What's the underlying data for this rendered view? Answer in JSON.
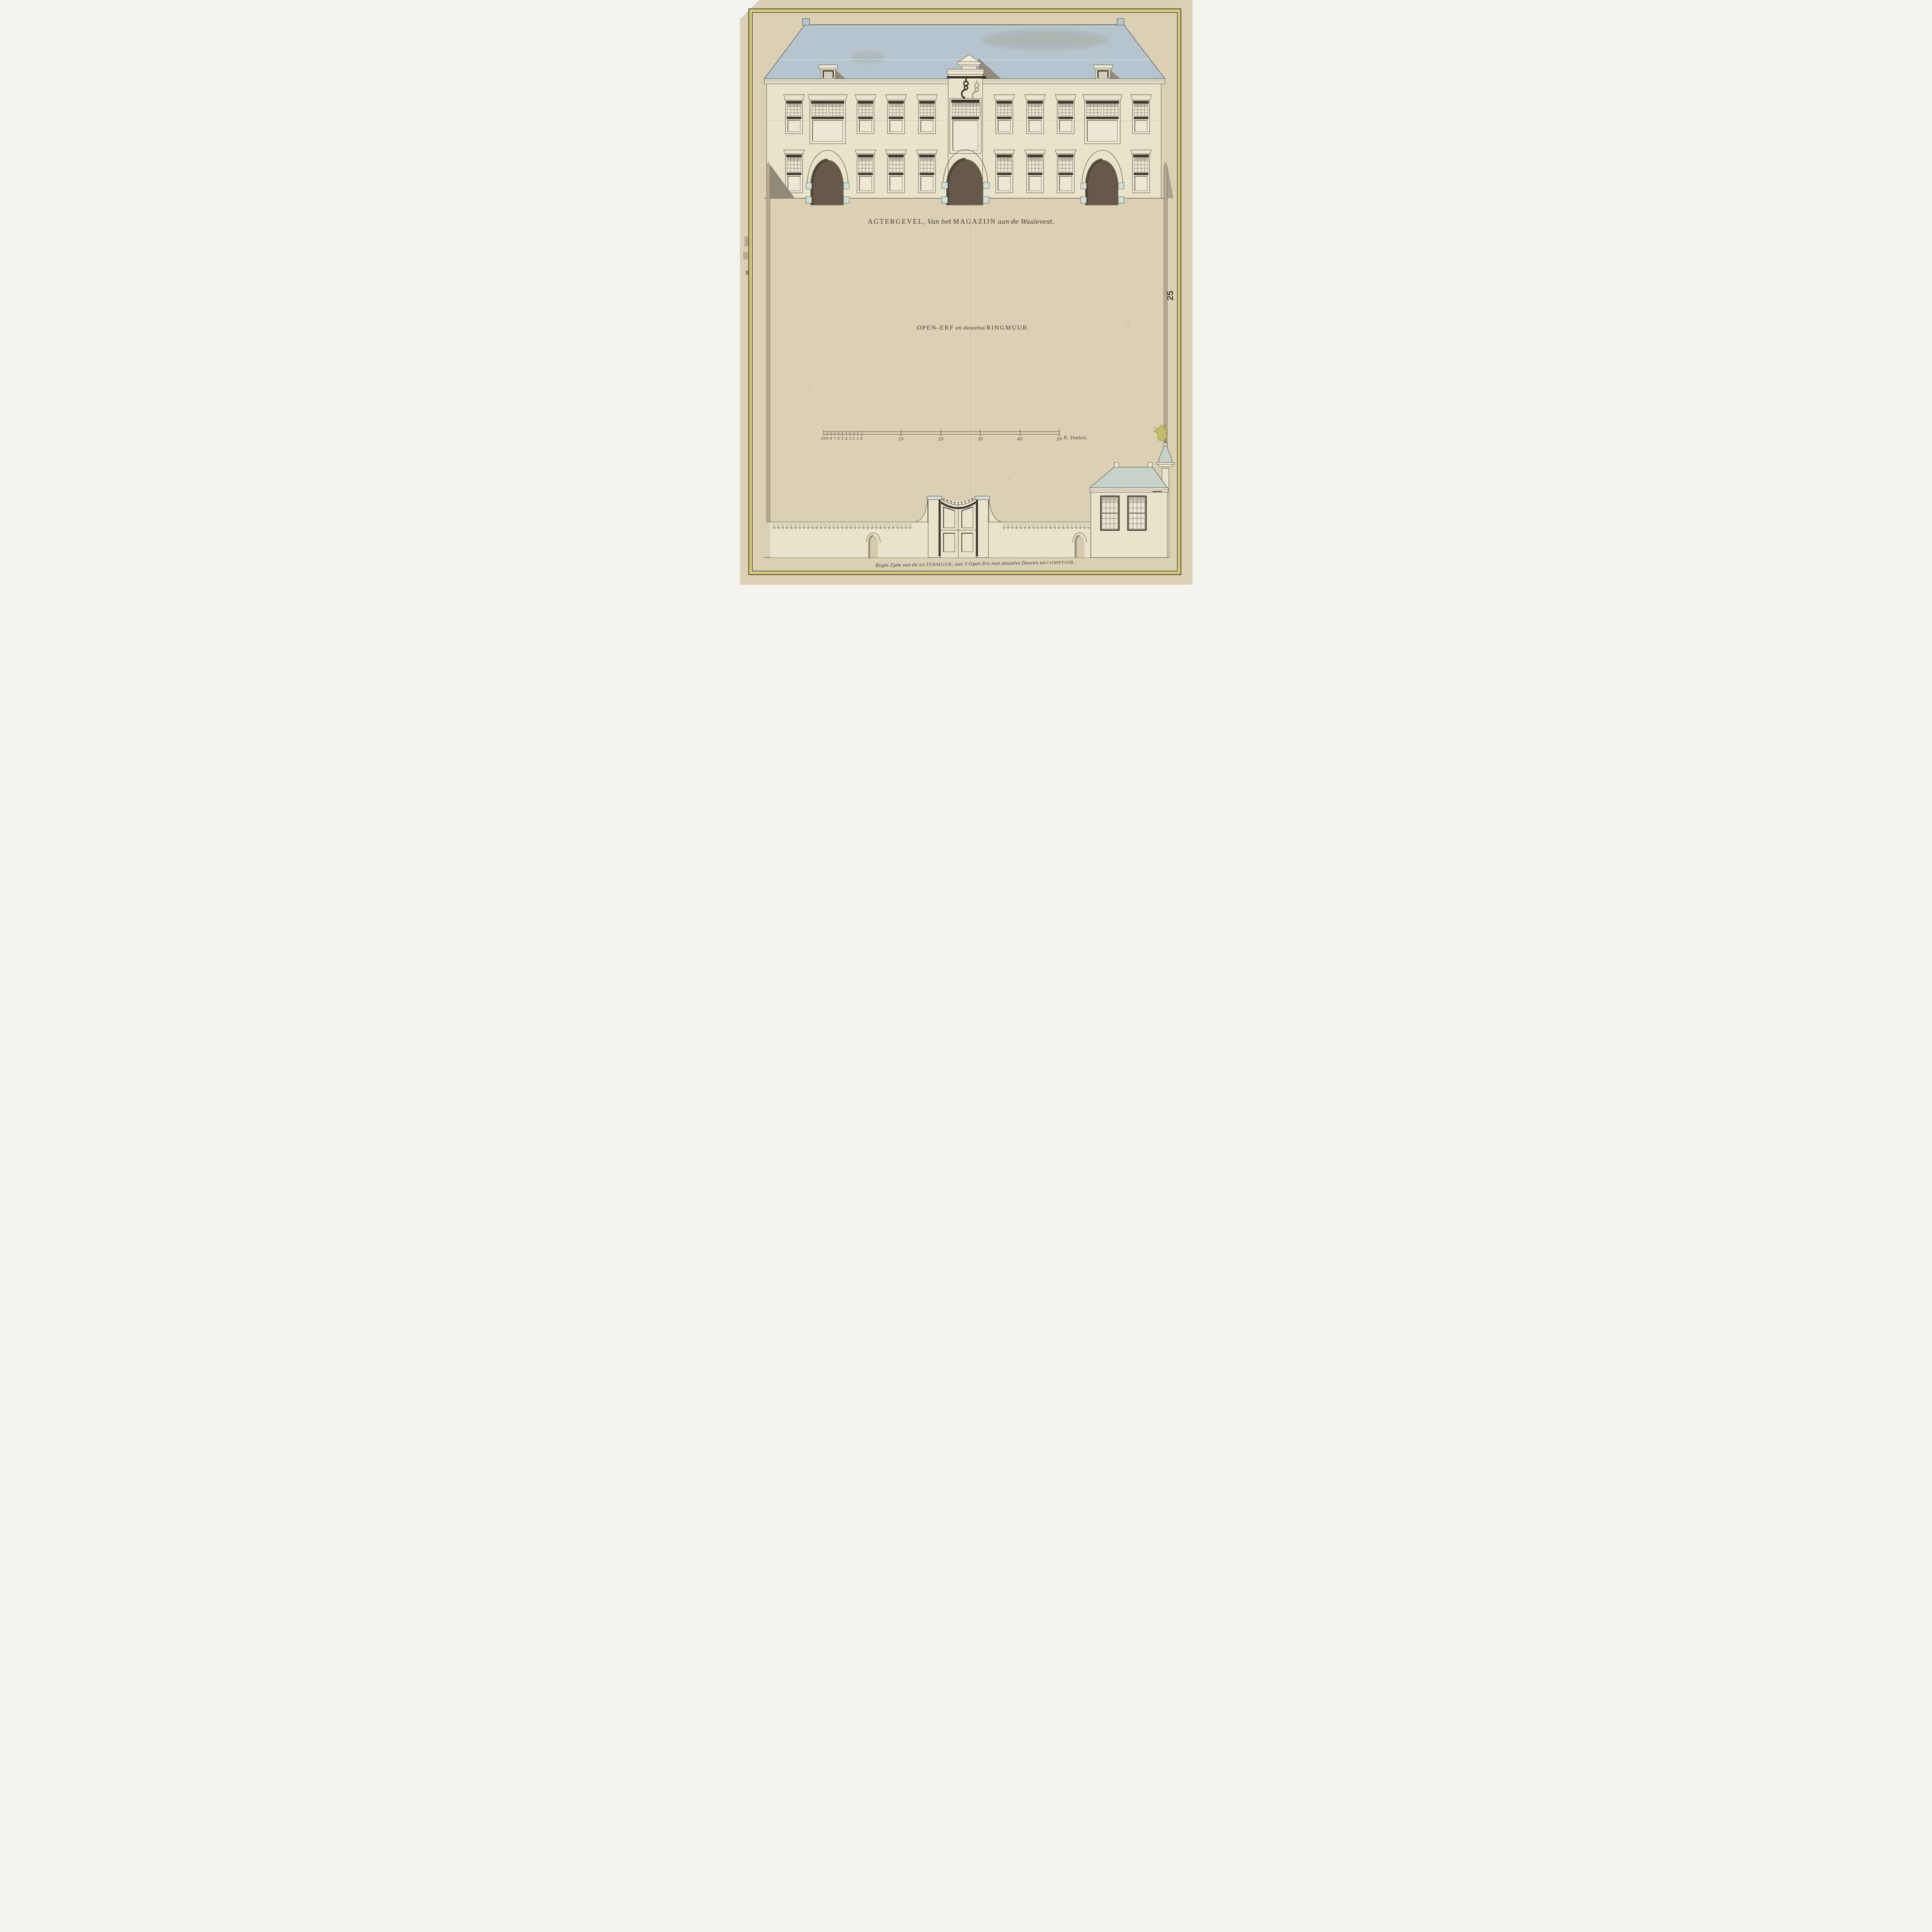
{
  "titles": {
    "facade": {
      "caps1": "AGTERGEVEL,",
      "script1": "Van het",
      "caps2": "MAGAZIJN",
      "script2": "aan de Waalevest."
    },
    "yard": {
      "caps1": "OPEN-ERF",
      "script1": "en deszelvs",
      "caps2": "RINGMUUR."
    },
    "caption": {
      "script1": "Buyte Zyde van de",
      "caps1": "AGTERMUUR,",
      "script2": "aan 't Open Erv met deszelvs Deuren en",
      "caps2": "COMPTOIR."
    }
  },
  "page_number": "25",
  "scale_bar": {
    "minor_labels": [
      "10",
      "9",
      "8",
      "7",
      "6",
      "5",
      "4",
      "3",
      "2",
      "1",
      "0"
    ],
    "major_labels": [
      "10",
      "20",
      "30",
      "40",
      "50"
    ],
    "unit_label": "R. Voeten."
  },
  "colors": {
    "backdrop": "#f4f3ee",
    "paper": "#d9d0b6",
    "paper_edge": "#b6a98d",
    "border_yellow": "#d7cc74",
    "border_line": "#5a5240",
    "ink": "#4c4537",
    "cream": "#eae3cc",
    "cream2": "#efe9d6",
    "glass": "#ece6d2",
    "grid_line": "#5c5446",
    "head_dark": "#3f382e",
    "roof_blue": "#b6c6cf",
    "roof_stain": "#8a6434",
    "comptoir_roof": "#c4d2ca",
    "arch_brown": "#66594a",
    "arch_brown_dark": "#473e31",
    "impost_blue": "#cfe0db",
    "post_tan": "#b4a88e",
    "shadow": "#8d8371",
    "text_dark": "#3e372a",
    "lion_gold": "#c2bd68",
    "niche_fill": "#d3cab0",
    "paper_line": "#b9ae93"
  }
}
